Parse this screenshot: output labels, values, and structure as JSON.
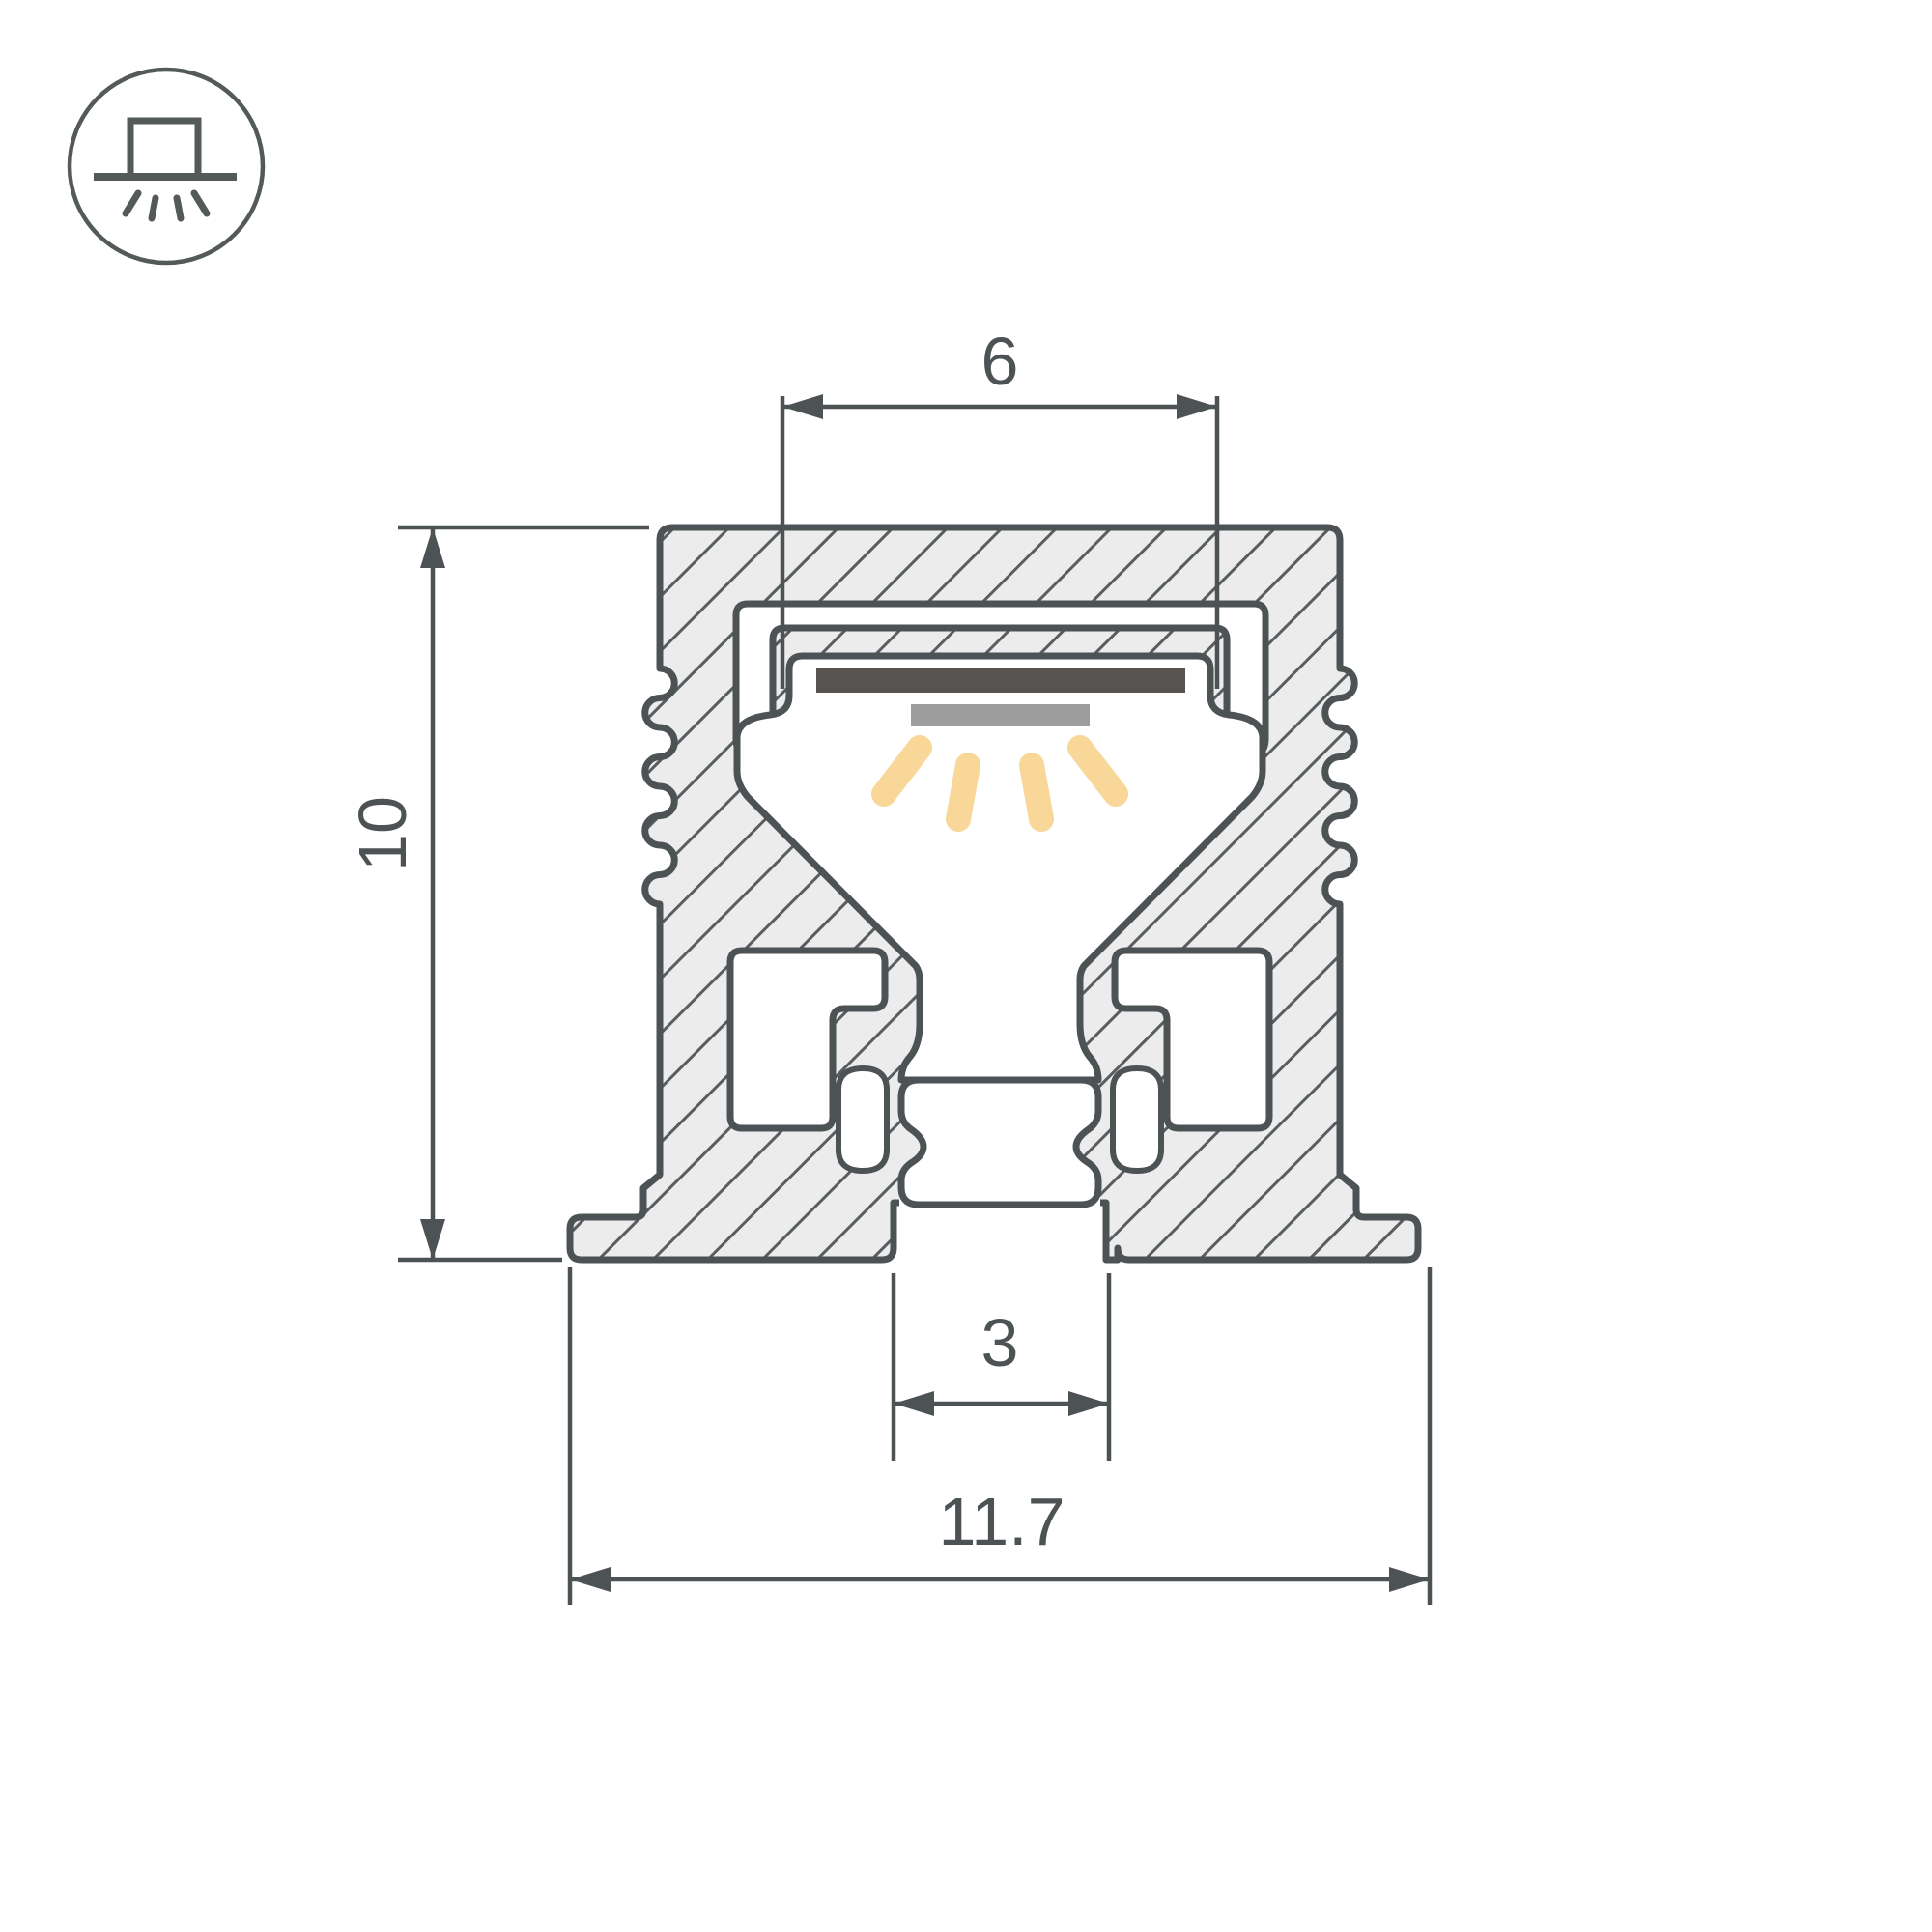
{
  "drawing": {
    "kind": "profile-cross-section-drawing",
    "icon": {
      "name": "recessed-downlight-icon"
    },
    "dimensions": {
      "top_slot_width": {
        "label": "6"
      },
      "overall_height": {
        "label": "10"
      },
      "bottom_slot_width": {
        "label": "3"
      },
      "overall_width": {
        "label": "11.7"
      }
    },
    "colors": {
      "outline": "#4d5254",
      "hatch_fill": "#ececec",
      "hatch_line": "#585d5d",
      "dimension": "#4d5254",
      "led_bar": "#575350",
      "emitter_bar": "#9d9d9d",
      "light_ray": "#f8d798",
      "background": "#ffffff"
    }
  }
}
